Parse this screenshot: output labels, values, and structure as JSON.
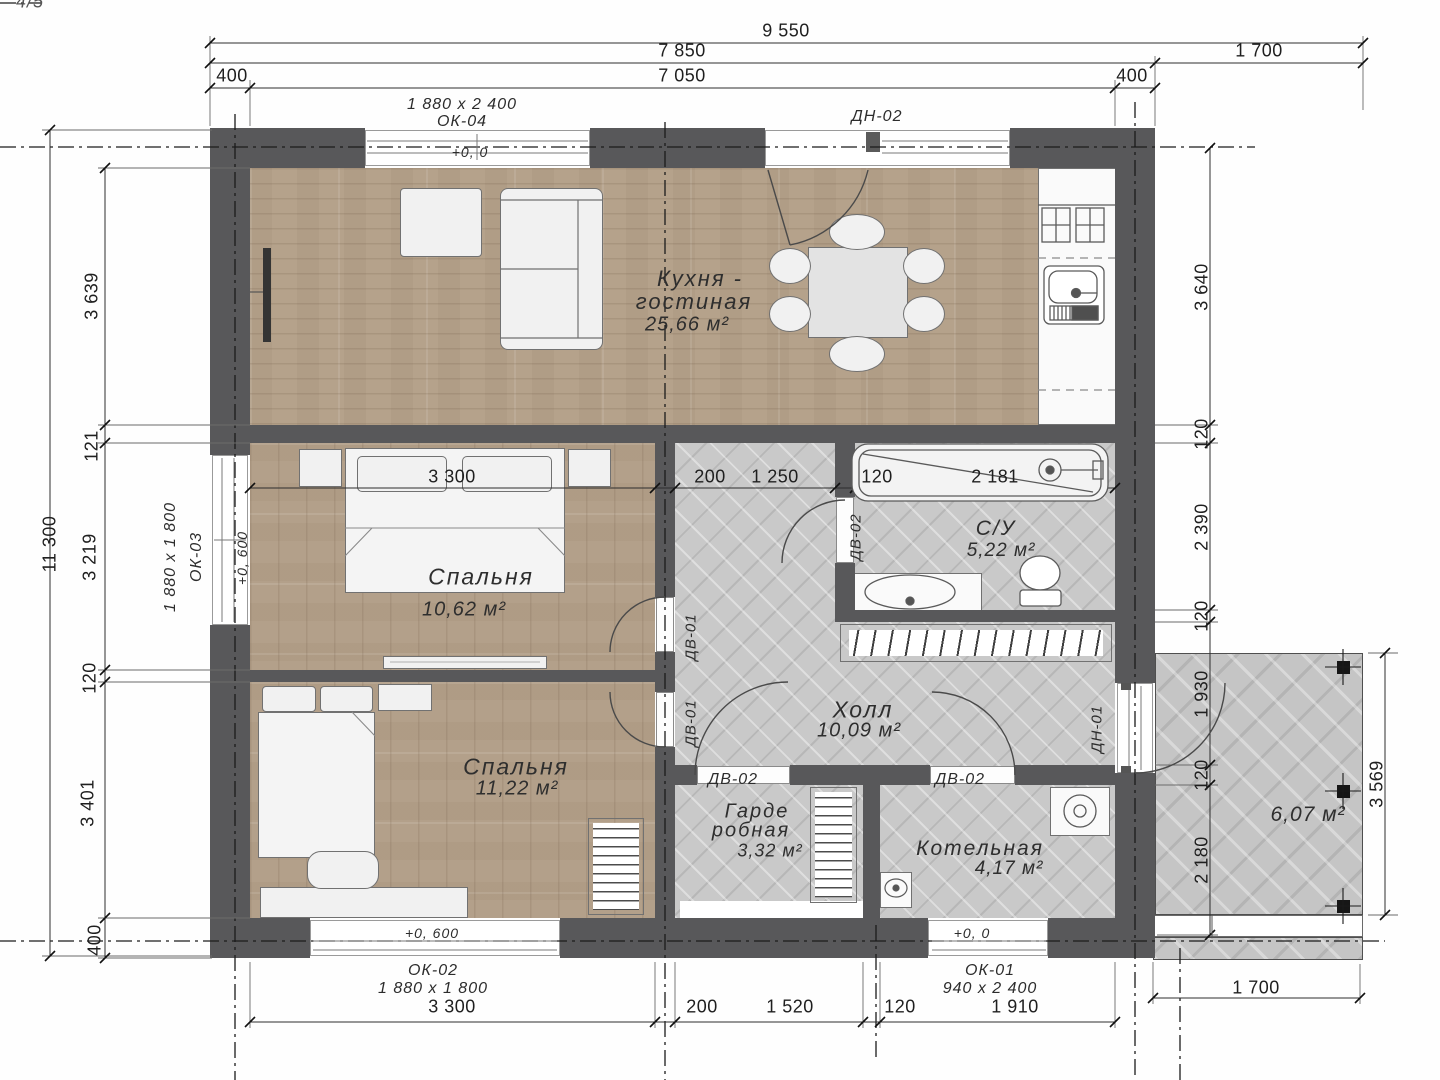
{
  "corner_note": "4/5",
  "dims": {
    "top": {
      "total": "9 550",
      "house": "7 850",
      "terrace": "1 700",
      "wall_left": "400",
      "inner": "7 050",
      "wall_right": "400"
    },
    "left": {
      "total": "11 300",
      "s1": "3 639",
      "s2": "121",
      "s3": "3 219",
      "s4": "120",
      "s5": "3 401",
      "s6": "400"
    },
    "right": {
      "s1": "3 640",
      "s2": "120",
      "s3": "2 390",
      "s4": "120",
      "s5": "1 930",
      "s6": "120",
      "s7": "2 180",
      "terrace_height": "3 569"
    },
    "middle": {
      "s1": "3 300",
      "s2": "200",
      "s3": "1 250",
      "s4": "120",
      "s5": "2 181"
    },
    "bottom": {
      "s1": "3 300",
      "s2": "200",
      "s3": "1 520",
      "s4": "120",
      "s5": "1 910",
      "terrace_width": "1 700"
    }
  },
  "levels": {
    "zero": "+0, 0",
    "plus600": "+0, 600"
  },
  "windows": {
    "ok04": {
      "name": "ОК-04",
      "size": "1 880 x 2 400"
    },
    "ok03": {
      "name": "ОК-03",
      "size": "1 880 x 1 800"
    },
    "ok02": {
      "name": "ОК-02",
      "size": "1 880 x 1 800"
    },
    "ok01": {
      "name": "ОК-01",
      "size": "940 x 2 400"
    }
  },
  "doors": {
    "dn01": "ДН-01",
    "dn02": "ДН-02",
    "dv01": "ДВ-01",
    "dv02": "ДВ-02"
  },
  "rooms": {
    "kitchen_living": {
      "name_line1": "Кухня -",
      "name_line2": "гостиная",
      "area": "25,66 м²"
    },
    "bedroom_top": {
      "name": "Спальня",
      "area": "10,62 м²"
    },
    "bedroom_bottom": {
      "name": "Спальня",
      "area": "11,22 м²"
    },
    "bathroom": {
      "name": "С/У",
      "area": "5,22 м²"
    },
    "hall": {
      "name": "Холл",
      "area": "10,09 м²"
    },
    "wardrobe": {
      "name_line1": "Гарде",
      "name_line2": "робная",
      "area": "3,32 м²"
    },
    "boiler": {
      "name": "Котельная",
      "area": "4,17 м²"
    },
    "terrace": {
      "area": "6,07 м²"
    }
  }
}
